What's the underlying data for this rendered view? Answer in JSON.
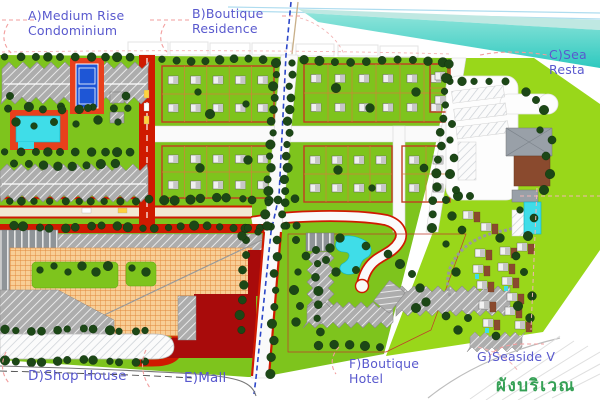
{
  "labels": {
    "a": "A)Medium Rise\nCondominium",
    "b": "B)Boutique\nResidence",
    "c": "C)Sea\nResta",
    "d": "D)Shop House",
    "e": "E)Mall",
    "f": "F)Boutique\nHotel",
    "g": "G)Seaside V"
  },
  "caption": {
    "thai": "ผังบริเวณ"
  },
  "colors": {
    "site-green": "#7EC41D",
    "bright-green": "#99D71A",
    "tree-green": "#1C4716",
    "road-red": "#CF1A00",
    "mall-red": "#A80B0B",
    "plaza-orange": "#F4A857",
    "pool-cyan": "#3FDDE8",
    "sea-teal": "#3ECFC5",
    "court-blue": "#1E56D6",
    "deck-red": "#E8401C",
    "canal-blue": "#2B46C8",
    "building-grey": "#ADADAD",
    "terrace-brown": "#8A4A2E",
    "label-purple": "#5959CE",
    "thai-green": "#35A055"
  }
}
